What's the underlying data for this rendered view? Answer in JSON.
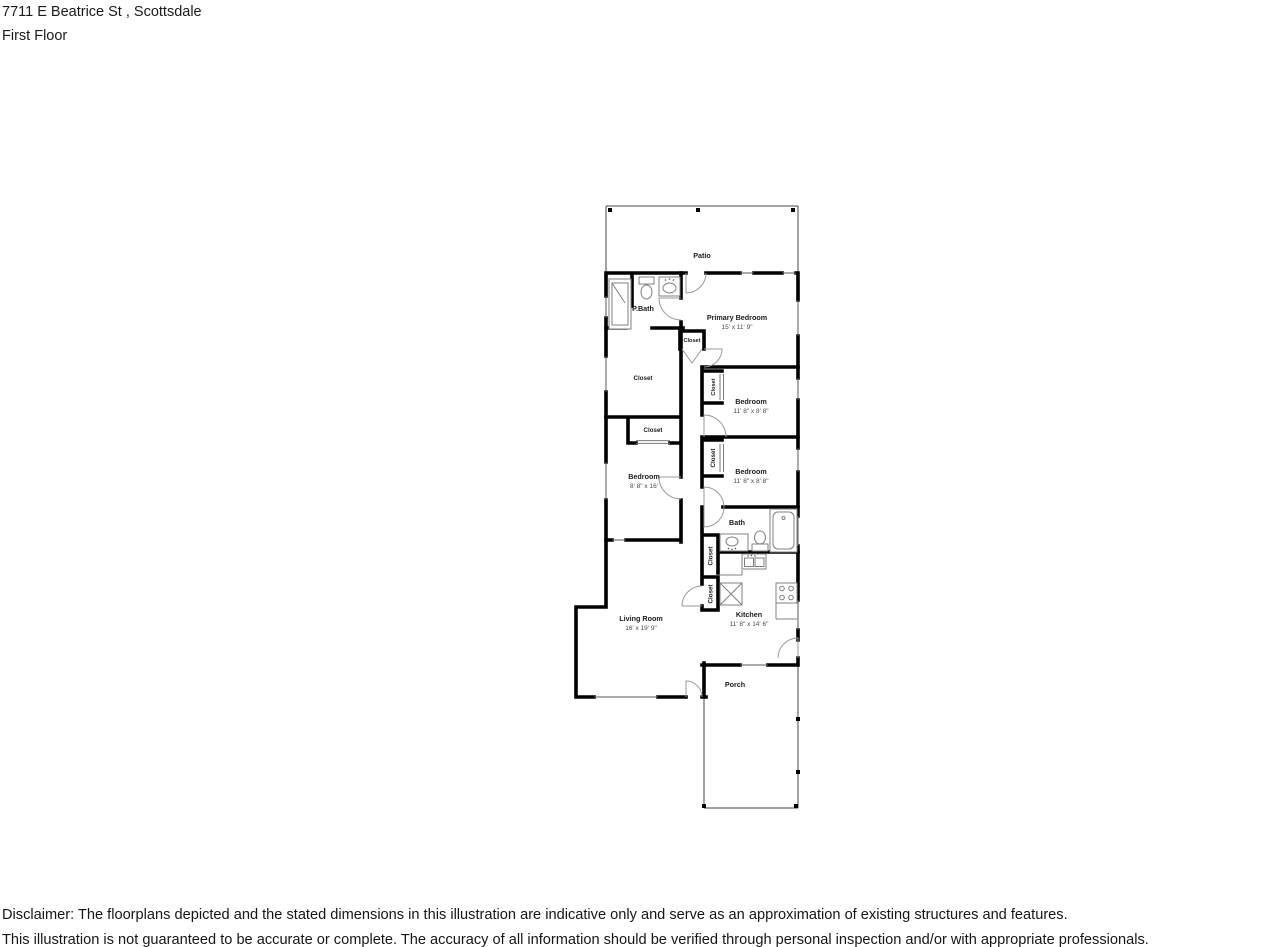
{
  "header": {
    "address": "7711 E Beatrice St , Scottsdale",
    "floor": "First Floor"
  },
  "floorplan": {
    "rooms": {
      "patio": {
        "name": "Patio"
      },
      "pbath": {
        "name": "P.Bath"
      },
      "primary_bedroom": {
        "name": "Primary Bedroom",
        "dims": "15' x 11' 9\""
      },
      "bedroom_right_upper": {
        "name": "Bedroom",
        "dims": "11' 8\" x 8' 8\""
      },
      "bedroom_right_lower": {
        "name": "Bedroom",
        "dims": "11' 8\" x 8' 8\""
      },
      "bedroom_left": {
        "name": "Bedroom",
        "dims": "8' 8\" x 16'"
      },
      "bath": {
        "name": "Bath"
      },
      "kitchen": {
        "name": "Kitchen",
        "dims": "11' 8\" x 14' 6\""
      },
      "living_room": {
        "name": "Living Room",
        "dims": "16' x 19' 9\""
      },
      "porch": {
        "name": "Porch"
      }
    },
    "closets": {
      "hall_top": "Closet",
      "walk_in": "Closet",
      "middle": "Closet",
      "bedroom_upper": "Closet",
      "bedroom_lower": "Closet",
      "hall_upper": "Closet",
      "hall_lower": "Closet"
    },
    "colors": {
      "walls": "#000000",
      "open_structure": "#474747",
      "fixtures": "#818181",
      "room_text": "#1c1c1c",
      "dim_text": "#4a4a4a"
    }
  },
  "disclaimer": {
    "line1": "Disclaimer: The floorplans depicted and the stated dimensions in this illustration are indicative only and serve as an approximation of existing structures and features.",
    "line2": "This illustration is not guaranteed to be accurate or complete. The accuracy of all information should be verified through personal inspection and/or with appropriate professionals."
  }
}
